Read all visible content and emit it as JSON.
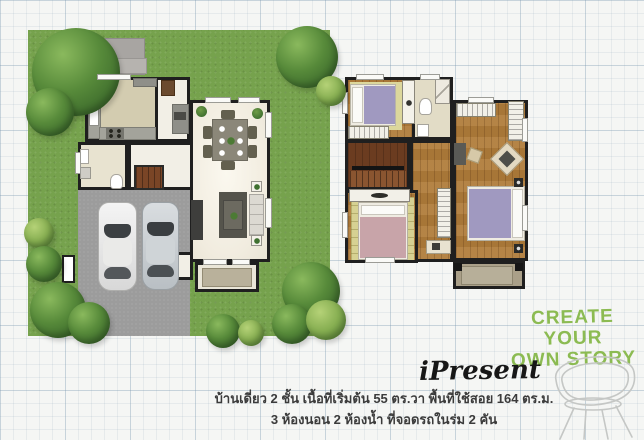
{
  "tagline": {
    "line1": "CREATE YOUR",
    "line2": "OWN STORY"
  },
  "brand": {
    "title": "iPresent"
  },
  "description": {
    "line1": "บ้านเดี่ยว 2 ชั้น เนื้อที่เริ่มต้น 55 ตร.วา  พื้นที่ใช้สอย 164 ตร.ม.",
    "line2": "3 ห้องนอน  2 ห้องน้ำ ที่จอดรถในร่ม 2 คัน"
  },
  "icons": {
    "chair_sketch": "wireframe-designer-chair"
  },
  "colors": {
    "accent_green": "#8cbb52",
    "grass_green": "#76a24d",
    "tree_green": "#4f7f38",
    "wood_brown": "#b07c3a",
    "dark_wood": "#6b3c20",
    "wall_black": "#1f1f1f",
    "driveway_gray": "#9c9c9c",
    "kitchen_beige": "#d3ccb0",
    "bath_beige": "#e8e3d0",
    "bed_lavender": "#a099c0",
    "bed_pink": "#c8a4a9",
    "rug_green": "#d6d192",
    "balcony_tan": "#aaa089",
    "text_dark": "#3b3b3b",
    "paper": "#f5f6f4"
  }
}
